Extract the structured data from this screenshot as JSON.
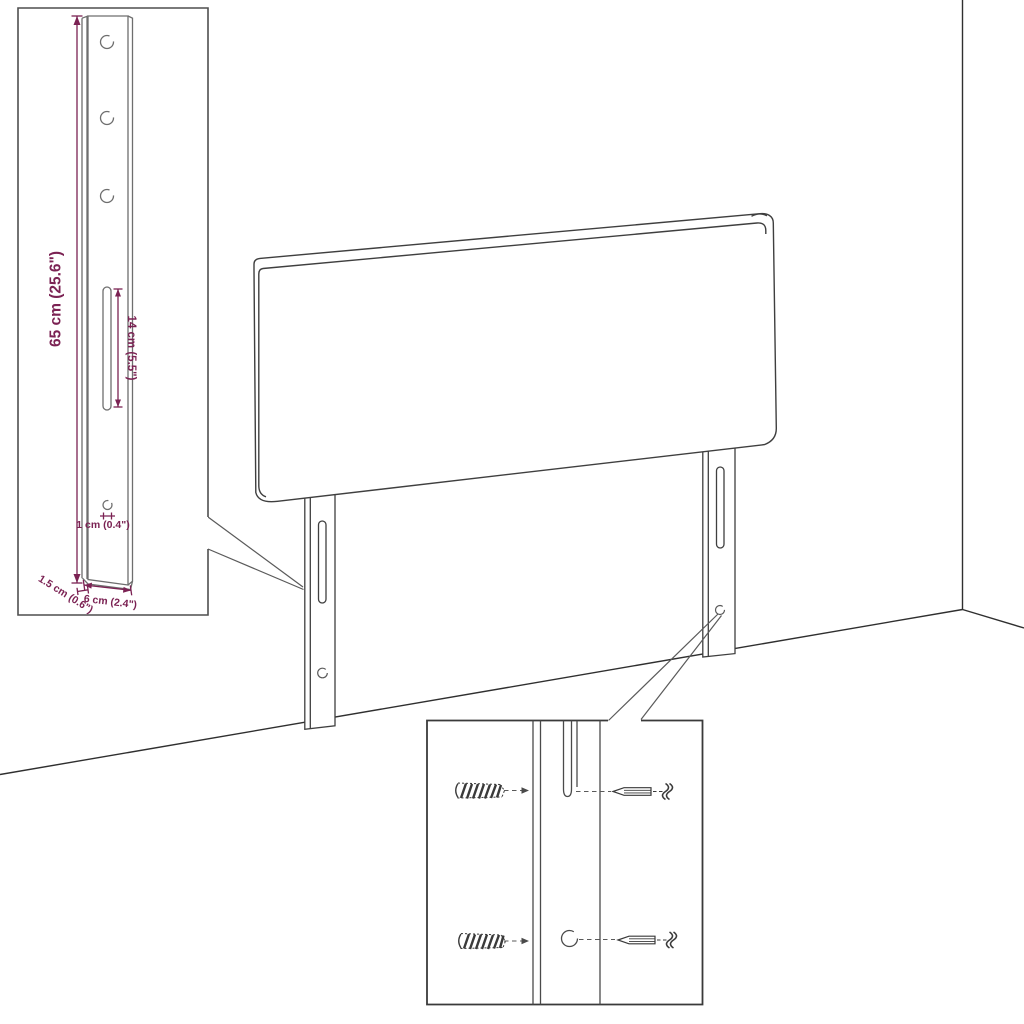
{
  "diagram": {
    "title": "Headboard with mounting legs - dimension diagram",
    "background_color": "#ffffff",
    "line_color": "#3f3f3f",
    "dimension_color": "#7b2253",
    "dimensions": {
      "leg_height": "65 cm (25.6\")",
      "slot_length": "14 cm (5.5\")",
      "hole_diameter": "1 cm (0.4\")",
      "leg_depth": "1.5 cm (0.6\")",
      "leg_width": "6 cm (2.4\")"
    },
    "insets": {
      "leg_detail": {
        "holes_count": 3,
        "slots_count": 1
      },
      "hardware_detail": {
        "wall_plugs_count": 2,
        "screws_count": 2
      }
    }
  }
}
